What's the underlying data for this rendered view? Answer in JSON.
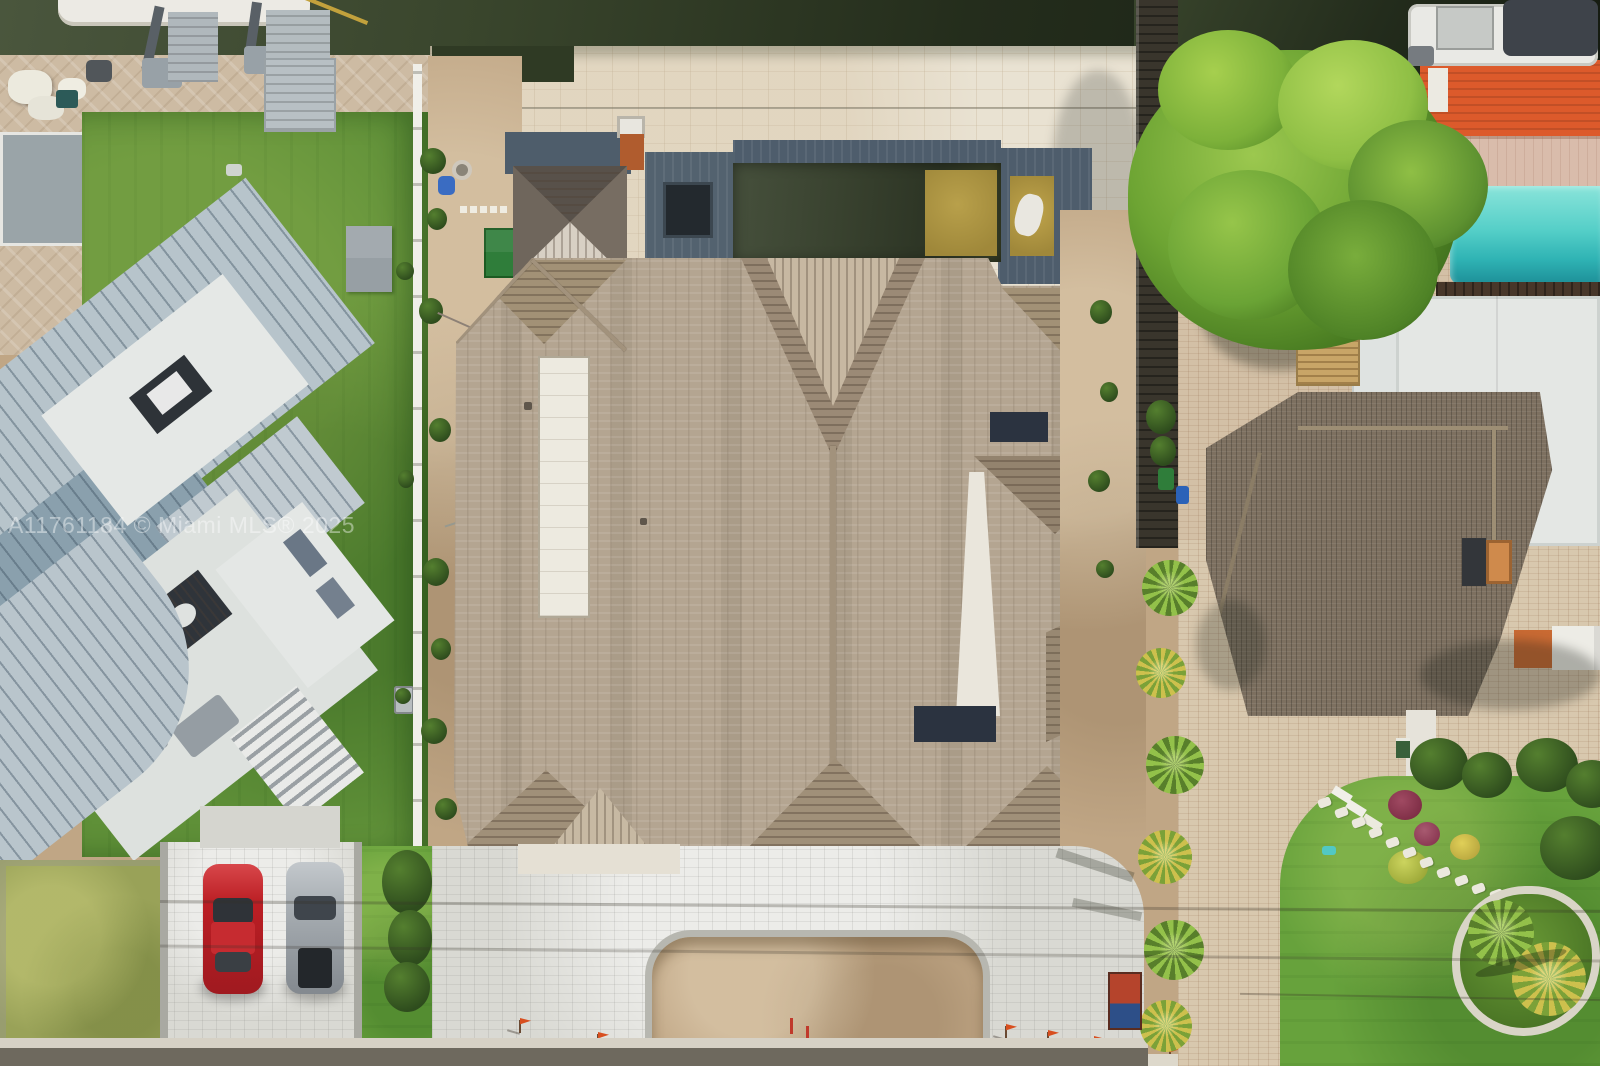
{
  "image": {
    "kind": "aerial-real-estate-photo",
    "subject": "waterfront house with large shingle roof, pool and paver driveway between two neighboring homes on a canal"
  },
  "watermark": {
    "text": "A11761184 © Miami MLS® 2025"
  },
  "palette": {
    "canal": "#39452c",
    "canalDark": "#10150d",
    "travertine": "#e9e2d2",
    "patioTan": "#cdbba3",
    "lawn": "#5f9038",
    "lawnBright": "#67a23c",
    "lawnDry": "#99a258",
    "roofShingle": "#b4a591",
    "roofBrown": "#7d7060",
    "metalRoof": "#b7c4cb",
    "metalRoofDark": "#8aa0ad",
    "poolDark": "#3d4733",
    "poolGold": "#b3973f",
    "slate": "#4e5d6c",
    "neighborPoolTeal": "#45c5c0",
    "orangeDeck": "#dc5a2b",
    "woodDeck": "#48372a",
    "paverWhite": "#d9d9d3",
    "paverBrick": "#d3c0a6",
    "dirt": "#c0a685",
    "street": "#6e695e",
    "carRed": "#bb1e24",
    "carSilver": "#a7adb2",
    "treeGreen": "#6da433",
    "hedge": "#2e4c1d",
    "fenceWhite": "#f0efe9",
    "flagOrange": "#d84f1f",
    "cupola": "#665e55",
    "rustChimney": "#b05c2e",
    "glassDark": "#2b3340"
  }
}
